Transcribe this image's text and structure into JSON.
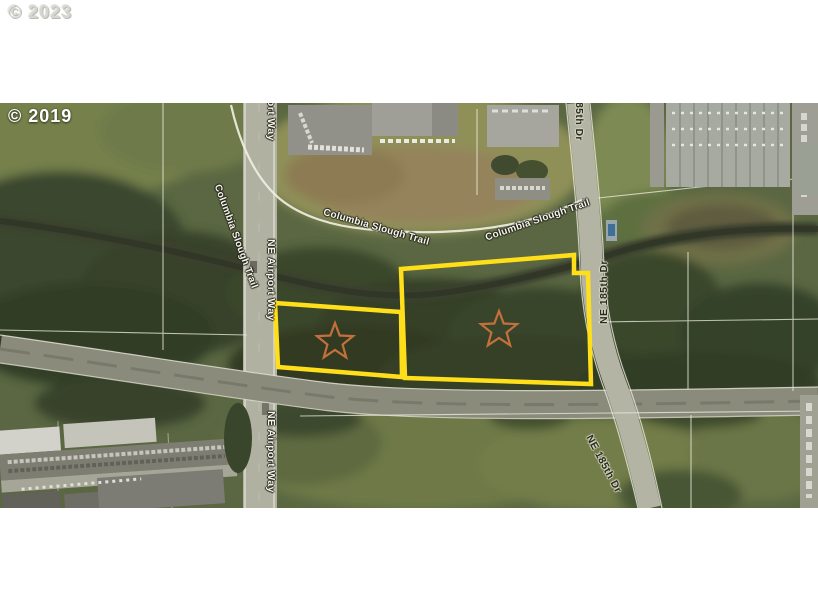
{
  "watermarks": {
    "top": "© 2023",
    "map": "© 2019"
  },
  "map_labels": {
    "airport_way": "NE Airport Way",
    "ne_185th_dr": "NE 185th Dr",
    "columbia_slough_trail": "Columbia Slough Trail"
  },
  "overlay": {
    "parcel_outline_color": "#ffdf1a",
    "star_marker_color": "#c2703c",
    "parcel_count": 2,
    "star_count": 2
  }
}
